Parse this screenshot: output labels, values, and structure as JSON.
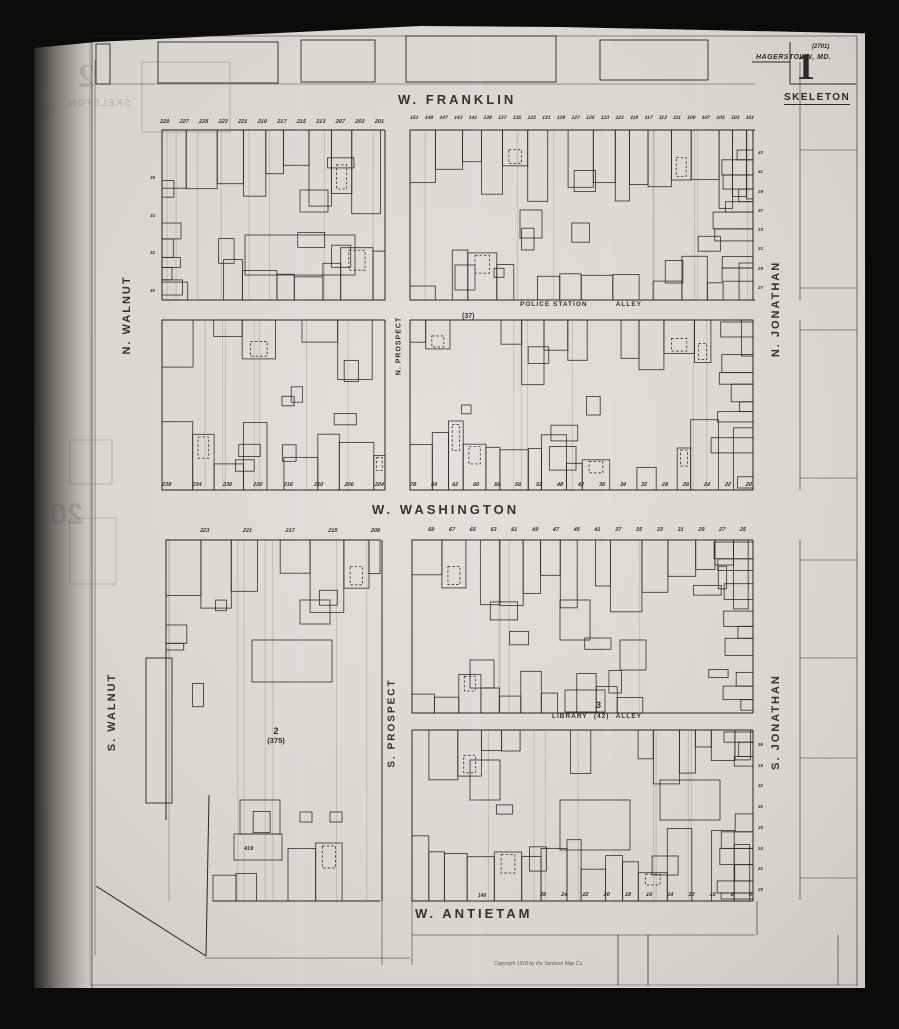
{
  "title_block": {
    "plate_code": "(2701)",
    "city": "HAGERSTOWN, MD.",
    "sheet_number": "1",
    "map_type": "SKELETON"
  },
  "streets": {
    "franklin": "W. FRANKLIN",
    "washington": "W. WASHINGTON",
    "antietam": "W. ANTIETAM",
    "n_walnut": "N. WALNUT",
    "s_walnut": "S. WALNUT",
    "n_prospect": "N. PROSPECT",
    "s_prospect": "S. PROSPECT",
    "n_jonathan": "N. JONATHAN",
    "s_jonathan": "S. JONATHAN"
  },
  "alleys": {
    "police_station": {
      "name_left": "POLICE STATION",
      "name_right": "ALLEY",
      "block_ref": "(37)"
    },
    "library": {
      "name_left": "LIBRARY",
      "block_ref": "(42)",
      "name_right": "ALLEY",
      "block_num": "3"
    }
  },
  "block_labels": {
    "sw_block_num": "2",
    "sw_block_ref": "(375)",
    "building_ref": "419",
    "antietam_single": "140"
  },
  "house_numbers": {
    "franklin_west": [
      "229",
      "227",
      "225",
      "223",
      "221",
      "219",
      "217",
      "215",
      "213",
      "207",
      "203",
      "201"
    ],
    "franklin_east": [
      "151",
      "149",
      "147",
      "143",
      "141",
      "139",
      "137",
      "135",
      "133",
      "131",
      "129",
      "127",
      "125",
      "123",
      "121",
      "119",
      "117",
      "113",
      "111",
      "109",
      "107",
      "105",
      "103",
      "101"
    ],
    "washington_north_west": [
      "238",
      "234",
      "230",
      "220",
      "216",
      "210",
      "206",
      "204"
    ],
    "washington_north_east": [
      "78",
      "64",
      "62",
      "60",
      "58",
      "56",
      "52",
      "48",
      "42",
      "36",
      "34",
      "32",
      "28",
      "26",
      "24",
      "22",
      "20"
    ],
    "washington_south_west": [
      "223",
      "221",
      "217",
      "215",
      "209"
    ],
    "washington_south_east": [
      "69",
      "67",
      "65",
      "63",
      "61",
      "49",
      "47",
      "45",
      "41",
      "37",
      "35",
      "33",
      "31",
      "29",
      "27",
      "25"
    ],
    "antietam_north": [
      "26",
      "24",
      "22",
      "20",
      "18",
      "16",
      "14",
      "12",
      "10",
      "8",
      "6"
    ],
    "walnut_east": [
      "36",
      "34",
      "32",
      "30"
    ],
    "jonathan_north": [
      "43",
      "41",
      "39",
      "37",
      "33",
      "31",
      "29",
      "27"
    ],
    "jonathan_south": [
      "36",
      "34",
      "32",
      "30",
      "26",
      "24",
      "22",
      "20"
    ]
  },
  "copyright": "Copyright 1918 by the Sanborn Map Co.",
  "ghost_bleedthrough": {
    "sheet_number": "2",
    "map_type": "SKELETON",
    "ref": "(2)",
    "page_number": "20"
  },
  "colors": {
    "film": "#0b0b0a",
    "paper": "#d9d6cf",
    "ink": "#24221c"
  }
}
